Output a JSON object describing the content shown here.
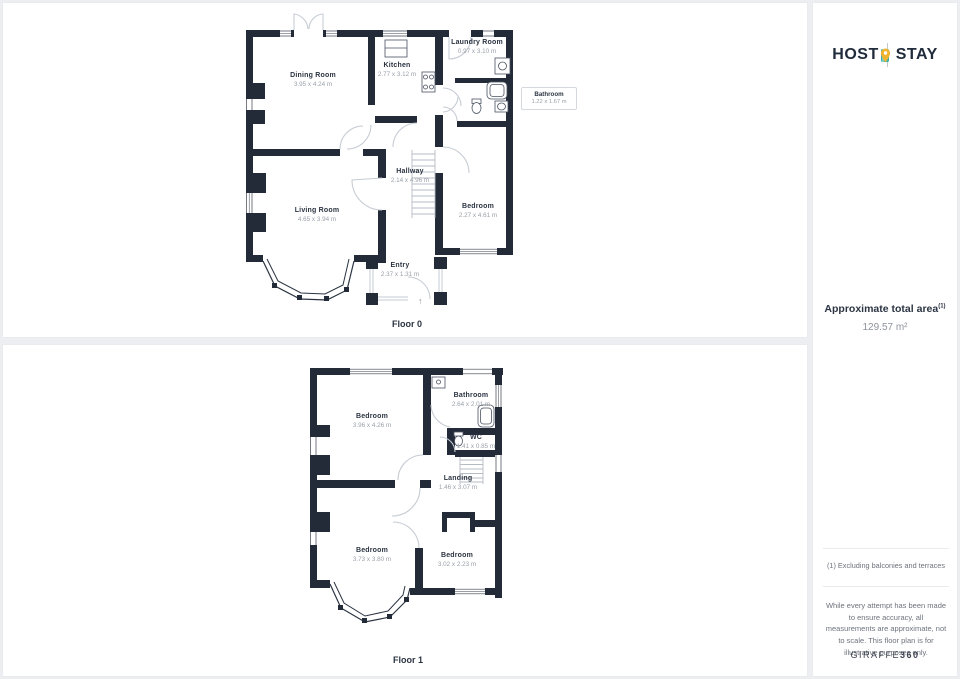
{
  "floor0": {
    "caption": "Floor 0",
    "entry_arrow": "↑",
    "rooms": {
      "dining": {
        "name": "Dining Room",
        "dims": "3.95 x 4.24 m"
      },
      "kitchen": {
        "name": "Kitchen",
        "dims": "2.77 x 3.12 m"
      },
      "laundry": {
        "name": "Laundry Room",
        "dims": "0.97 x 3.10 m"
      },
      "bathroom": {
        "name": "Bathroom",
        "dims": "1.22 x 1.67 m"
      },
      "hallway": {
        "name": "Hallway",
        "dims": "2.14 x 4.96 m"
      },
      "living": {
        "name": "Living Room",
        "dims": "4.65 x 3.94 m"
      },
      "bedroom": {
        "name": "Bedroom",
        "dims": "2.27 x 4.61 m"
      },
      "entry": {
        "name": "Entry",
        "dims": "2.37 x 1.31 m"
      }
    }
  },
  "floor1": {
    "caption": "Floor 1",
    "rooms": {
      "bedroom_top": {
        "name": "Bedroom",
        "dims": "3.96 x 4.26 m"
      },
      "bathroom": {
        "name": "Bathroom",
        "dims": "2.64 x 2.01 m"
      },
      "wc": {
        "name": "WC",
        "dims": "1.41 x 0.85 m"
      },
      "landing": {
        "name": "Landing",
        "dims": "1.46 x 3.07 m"
      },
      "bedroom_left": {
        "name": "Bedroom",
        "dims": "3.73 x 3.80 m"
      },
      "bedroom_right": {
        "name": "Bedroom",
        "dims": "3.02 x 2.23 m"
      }
    }
  },
  "sidebar": {
    "brand": {
      "host": "HOST",
      "stay": "STAY"
    },
    "area_title": "Approximate total area",
    "area_superscript": "(1)",
    "area_value": "129.57 m²",
    "footnote": "(1) Excluding balconies and terraces",
    "disclaimer": "While every attempt has been made to ensure accuracy, all measurements are approximate, not to scale. This floor plan is for illustrative purposes only.",
    "credit_normal": "GIRAFFE",
    "credit_bold": "360"
  },
  "colors": {
    "wall": "#232b39",
    "room_name": "#2b3442",
    "room_dims": "#9aa0a9",
    "door_line": "#c6ccd4",
    "brand_text": "#202b3b",
    "brand_teal": "#3fb0a5",
    "brand_gold": "#f0b42f",
    "panel_bg": "#ffffff",
    "page_bg": "#eceef1"
  }
}
